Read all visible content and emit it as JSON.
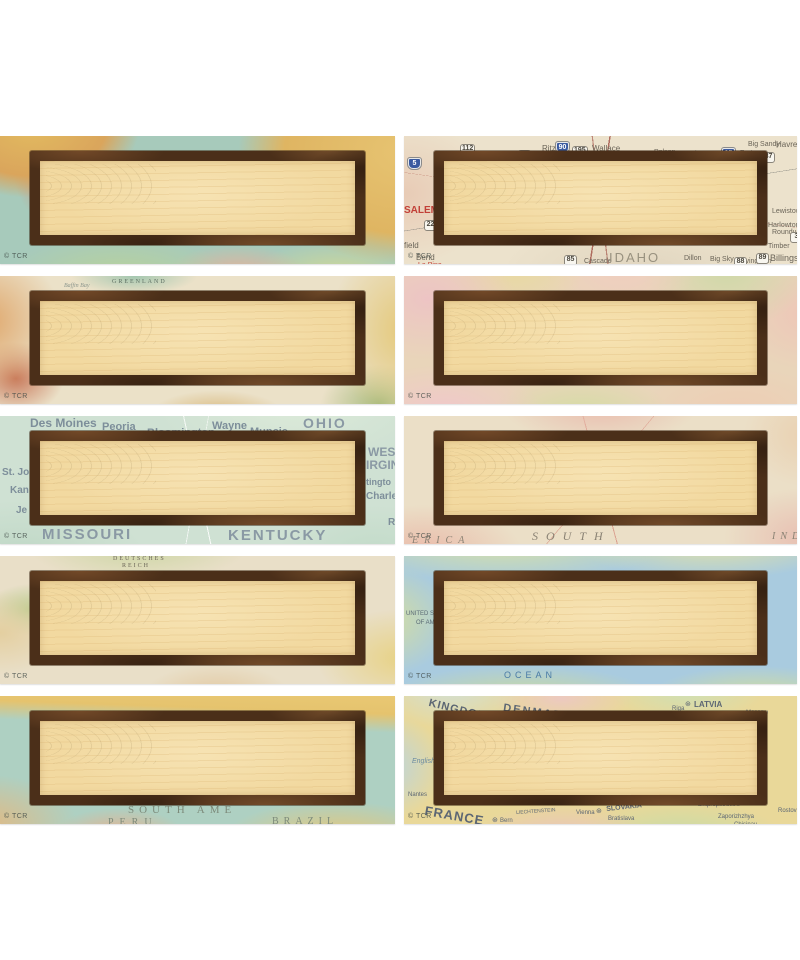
{
  "page": {
    "background": "#ffffff"
  },
  "palette": {
    "frame_brown": "#4b2f19",
    "frame_rust": "#7c5330",
    "panel_tan": "#f2d9a0",
    "copyright_gray": "#4a5a52"
  },
  "tiles": [
    {
      "name": "label-vintage-south-america-coast",
      "style": "style-vsa",
      "copyright": "© TCR",
      "labels": []
    },
    {
      "name": "label-us-road-map-idaho",
      "style": "style-road",
      "copyright": "© TCR",
      "labels": [
        {
          "t": "Ritzville",
          "x": 138,
          "y": 9,
          "s": 8,
          "c": "#6a6458"
        },
        {
          "t": "Wallace",
          "x": 188,
          "y": 9,
          "s": 8,
          "c": "#6a6458"
        },
        {
          "t": "Polson",
          "x": 250,
          "y": 13,
          "s": 7,
          "c": "#6a6458"
        },
        {
          "t": "Chateau",
          "x": 286,
          "y": 15,
          "s": 7,
          "c": "#6a6458"
        },
        {
          "t": "Fort",
          "x": 336,
          "y": 14,
          "s": 7,
          "c": "#6a6458"
        },
        {
          "t": "Big Sandy",
          "x": 344,
          "y": 5,
          "s": 7,
          "c": "#6a6458"
        },
        {
          "t": "Havre",
          "x": 372,
          "y": 5,
          "s": 8,
          "c": "#6a6458"
        },
        {
          "t": "Lewistown",
          "x": 368,
          "y": 72,
          "s": 7,
          "c": "#6a6458"
        },
        {
          "t": "Harlowton",
          "x": 364,
          "y": 86,
          "s": 7,
          "c": "#6a6458"
        },
        {
          "t": "Roundup",
          "x": 368,
          "y": 93,
          "s": 7,
          "c": "#6a6458"
        },
        {
          "t": "Timber",
          "x": 364,
          "y": 107,
          "s": 7,
          "c": "#6a6458"
        },
        {
          "t": "Billings",
          "x": 366,
          "y": 118,
          "s": 9,
          "c": "#6a6458"
        },
        {
          "t": "Livingston",
          "x": 336,
          "y": 122,
          "s": 7,
          "c": "#6a6458"
        },
        {
          "t": "Big Sky",
          "x": 306,
          "y": 120,
          "s": 7,
          "c": "#6a6458"
        },
        {
          "t": "Dillon",
          "x": 280,
          "y": 119,
          "s": 7,
          "c": "#6a6458"
        },
        {
          "t": "Cascade",
          "x": 180,
          "y": 122,
          "s": 7,
          "c": "#6a6458"
        },
        {
          "t": "IDAHO",
          "x": 205,
          "y": 115,
          "s": 13,
          "c": "#98917f",
          "ls": 2
        },
        {
          "t": "SALEM",
          "x": 0,
          "y": 70,
          "s": 10,
          "c": "#c24038",
          "w": 700
        },
        {
          "t": "field",
          "x": 0,
          "y": 106,
          "s": 8,
          "c": "#6a6458"
        },
        {
          "t": "Bend",
          "x": 12,
          "y": 118,
          "s": 8,
          "c": "#6a6458"
        },
        {
          "t": "La Pine",
          "x": 14,
          "y": 126,
          "s": 7,
          "c": "#c24038"
        },
        {
          "t": "5",
          "x": 4,
          "y": 22,
          "b": "i"
        },
        {
          "t": "90",
          "x": 152,
          "y": 6,
          "b": "i"
        },
        {
          "t": "15",
          "x": 318,
          "y": 12,
          "b": "i"
        },
        {
          "t": "112",
          "x": 56,
          "y": 8,
          "b": "r"
        },
        {
          "t": "17",
          "x": 114,
          "y": 14,
          "b": "r"
        },
        {
          "t": "195",
          "x": 168,
          "y": 10,
          "b": "r"
        },
        {
          "t": "22",
          "x": 20,
          "y": 84,
          "b": "r"
        },
        {
          "t": "12",
          "x": 328,
          "y": 23,
          "b": "r"
        },
        {
          "t": "87",
          "x": 358,
          "y": 16,
          "b": "r"
        },
        {
          "t": "3",
          "x": 386,
          "y": 96,
          "b": "r"
        },
        {
          "t": "89",
          "x": 352,
          "y": 117,
          "b": "r"
        },
        {
          "t": "88",
          "x": 330,
          "y": 121,
          "b": "r"
        },
        {
          "t": "85",
          "x": 160,
          "y": 119,
          "b": "r"
        }
      ]
    },
    {
      "name": "label-parchment-world-map-greenland",
      "style": "style-world",
      "copyright": "© TCR",
      "labels": [
        {
          "t": "GREENLAND",
          "x": 112,
          "y": 3,
          "s": 6,
          "c": "#5c6e62",
          "ls": 2,
          "sf": true
        },
        {
          "t": "Baffin Bay",
          "x": 64,
          "y": 7,
          "s": 6,
          "c": "#8a958c",
          "it": true,
          "sf": true
        }
      ]
    },
    {
      "name": "label-pastel-political-map",
      "style": "style-pastel",
      "copyright": "© TCR",
      "labels": []
    },
    {
      "name": "label-us-midwest-map",
      "style": "style-green",
      "copyright": "© TCR",
      "labels": [
        {
          "t": "Des Moines",
          "x": 30,
          "y": 1,
          "s": 12,
          "c": "#7d8e9a",
          "w": 600
        },
        {
          "t": "Peoria",
          "x": 102,
          "y": 6,
          "s": 11,
          "c": "#7d8e9a",
          "w": 600
        },
        {
          "t": "Bloomington",
          "x": 147,
          "y": 12,
          "s": 11,
          "c": "#7d8e9a",
          "w": 600
        },
        {
          "t": "Wayne",
          "x": 212,
          "y": 5,
          "s": 11,
          "c": "#7d8e9a",
          "w": 600
        },
        {
          "t": "Muncie",
          "x": 250,
          "y": 11,
          "s": 11,
          "c": "#7d8e9a",
          "w": 600
        },
        {
          "t": "OHIO",
          "x": 303,
          "y": 0,
          "s": 14,
          "c": "#8a99a4",
          "ls": 2,
          "w": 600
        },
        {
          "t": "WES",
          "x": 368,
          "y": 30,
          "s": 12,
          "c": "#8a99a4",
          "w": 600
        },
        {
          "t": "IRGIN",
          "x": 366,
          "y": 43,
          "s": 12,
          "c": "#8a99a4",
          "w": 600
        },
        {
          "t": "tingto",
          "x": 366,
          "y": 62,
          "s": 9,
          "c": "#7d8e9a",
          "w": 600
        },
        {
          "t": "Charle",
          "x": 366,
          "y": 76,
          "s": 10,
          "c": "#7d8e9a",
          "w": 600
        },
        {
          "t": "St. Jo",
          "x": 2,
          "y": 52,
          "s": 10,
          "c": "#7d8e9a",
          "w": 600
        },
        {
          "t": "Kan",
          "x": 10,
          "y": 70,
          "s": 10,
          "c": "#7d8e9a",
          "w": 600
        },
        {
          "t": "Je",
          "x": 16,
          "y": 90,
          "s": 10,
          "c": "#7d8e9a",
          "w": 600
        },
        {
          "t": "MISSOURI",
          "x": 42,
          "y": 111,
          "s": 15,
          "c": "#8a99a4",
          "ls": 2,
          "w": 600
        },
        {
          "t": "KENTUCKY",
          "x": 228,
          "y": 112,
          "s": 15,
          "c": "#8a99a4",
          "ls": 2,
          "w": 600
        },
        {
          "t": "R",
          "x": 388,
          "y": 102,
          "s": 10,
          "c": "#7d8e9a",
          "w": 600
        }
      ]
    },
    {
      "name": "label-vintage-south-america-routes",
      "style": "style-vpink",
      "copyright": "© TCR",
      "labels": [
        {
          "t": "SOUTH",
          "x": 128,
          "y": 114,
          "s": 12,
          "c": "#8a8274",
          "ls": 8,
          "it": true,
          "sf": true
        },
        {
          "t": "ERICA",
          "x": 8,
          "y": 120,
          "s": 10,
          "c": "#8a8274",
          "ls": 6,
          "it": true,
          "sf": true
        },
        {
          "t": "IND",
          "x": 368,
          "y": 116,
          "s": 10,
          "c": "#8a8274",
          "ls": 5,
          "it": true,
          "sf": true
        }
      ]
    },
    {
      "name": "label-vintage-europe-map",
      "style": "style-veuro",
      "copyright": "© TCR",
      "labels": [
        {
          "t": "DEUTSCHES",
          "x": 113,
          "y": 0,
          "s": 6,
          "c": "#6a6456",
          "ls": 2,
          "sf": true
        },
        {
          "t": "REICH",
          "x": 122,
          "y": 7,
          "s": 6,
          "c": "#6a6456",
          "ls": 2,
          "sf": true
        }
      ]
    },
    {
      "name": "label-atlas-ocean-map",
      "style": "style-atlas",
      "copyright": "© TCR",
      "labels": [
        {
          "t": "UNITED STATES",
          "x": 2,
          "y": 55,
          "s": 6,
          "c": "#5a6a74"
        },
        {
          "t": "OF AMERICA",
          "x": 12,
          "y": 64,
          "s": 6,
          "c": "#5a6a74"
        },
        {
          "t": "OCEAN",
          "x": 100,
          "y": 115,
          "s": 9,
          "c": "#4a7ba6",
          "ls": 4
        }
      ]
    },
    {
      "name": "label-vintage-south-america-peru-brazil",
      "style": "style-vsa2",
      "copyright": "© TCR",
      "labels": [
        {
          "t": "SOUTH AME",
          "x": 128,
          "y": 109,
          "s": 11,
          "c": "#7c8a7a",
          "ls": 5,
          "sf": true
        },
        {
          "t": "PERU",
          "x": 108,
          "y": 122,
          "s": 10,
          "c": "#7c8a7a",
          "ls": 6,
          "sf": true
        },
        {
          "t": "BRAZIL",
          "x": 272,
          "y": 121,
          "s": 10,
          "c": "#7c8a7a",
          "ls": 5,
          "sf": true
        }
      ]
    },
    {
      "name": "label-modern-europe-map",
      "style": "style-meuro",
      "copyright": "© TCR",
      "labels": [
        {
          "t": "KINGDOM",
          "x": 26,
          "y": 2,
          "s": 11,
          "c": "#5c6673",
          "w": 700,
          "r": 14,
          "ls": 1
        },
        {
          "t": "DENMARK",
          "x": 100,
          "y": 7,
          "s": 11,
          "c": "#5c6673",
          "w": 700,
          "r": 8,
          "ls": 2
        },
        {
          "t": "Copenhagen",
          "x": 160,
          "y": 21,
          "s": 6,
          "c": "#5c6673"
        },
        {
          "t": "Riga",
          "x": 268,
          "y": 10,
          "s": 6,
          "c": "#5c6673"
        },
        {
          "t": "⊛",
          "x": 281,
          "y": 5,
          "s": 7,
          "c": "#5c6673"
        },
        {
          "t": "LATVIA",
          "x": 290,
          "y": 5,
          "s": 8,
          "c": "#5c6673",
          "w": 700
        },
        {
          "t": "Moscow",
          "x": 342,
          "y": 14,
          "s": 6,
          "c": "#5c6673"
        },
        {
          "t": "English Ch.",
          "x": 8,
          "y": 62,
          "s": 7,
          "c": "#6a8aa0",
          "it": true
        },
        {
          "t": "Nantes",
          "x": 4,
          "y": 96,
          "s": 6,
          "c": "#5c6673"
        },
        {
          "t": "FRANCE",
          "x": 22,
          "y": 108,
          "s": 13,
          "c": "#5c6673",
          "w": 700,
          "r": 10,
          "ls": 1
        },
        {
          "t": "⊛",
          "x": 88,
          "y": 121,
          "s": 7,
          "c": "#5c6673"
        },
        {
          "t": "Bern",
          "x": 96,
          "y": 122,
          "s": 6,
          "c": "#5c6673"
        },
        {
          "t": "LIECHTENSTEIN",
          "x": 112,
          "y": 115,
          "s": 5,
          "c": "#5c6673",
          "r": -4
        },
        {
          "t": "Vienna",
          "x": 172,
          "y": 114,
          "s": 6,
          "c": "#5c6673"
        },
        {
          "t": "⊛",
          "x": 192,
          "y": 112,
          "s": 7,
          "c": "#5c6673"
        },
        {
          "t": "SLOVAKIA",
          "x": 202,
          "y": 110,
          "s": 7,
          "c": "#5c6673",
          "w": 700,
          "r": -6
        },
        {
          "t": "Bratislava",
          "x": 204,
          "y": 120,
          "s": 6,
          "c": "#5c6673"
        },
        {
          "t": "Dnipropetrovs'k",
          "x": 294,
          "y": 106,
          "s": 6,
          "c": "#5c6673"
        },
        {
          "t": "Zaporizhzhya",
          "x": 314,
          "y": 118,
          "s": 6,
          "c": "#5c6673"
        },
        {
          "t": "Chisinau",
          "x": 330,
          "y": 126,
          "s": 6,
          "c": "#5c6673"
        },
        {
          "t": "Rostov",
          "x": 374,
          "y": 112,
          "s": 6,
          "c": "#5c6673"
        }
      ]
    }
  ]
}
